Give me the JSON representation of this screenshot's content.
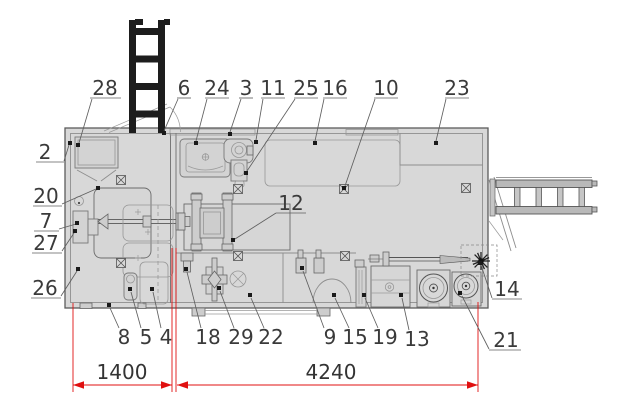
{
  "meta": {
    "drawing_type": "trailer-floor-plan",
    "description": "Top view layout plan of a mobile workshop trailer with numbered callouts and overall dimensions"
  },
  "colors": {
    "dimension": "#e01010",
    "interior": "#d8d8d8",
    "ladder": "#1d1d1d",
    "label": "#3a3a3a"
  },
  "dimensions": [
    {
      "label": "1400",
      "y": 385,
      "x1": 73,
      "x2": 172,
      "text_x": 122,
      "text_y": 379
    },
    {
      "label": "4240",
      "y": 385,
      "x1": 177,
      "x2": 478,
      "text_x": 331,
      "text_y": 379
    }
  ],
  "extension_lines": [
    {
      "x": 73,
      "y1": 303,
      "y2": 392
    },
    {
      "x": 172,
      "y1": 248,
      "y2": 392
    },
    {
      "x": 176,
      "y1": 248,
      "y2": 392
    },
    {
      "x": 478,
      "y1": 302,
      "y2": 392
    }
  ],
  "symbols": [
    {
      "type": "crossed-box",
      "x": 121,
      "y": 180
    },
    {
      "type": "crossed-box",
      "x": 121,
      "y": 263
    },
    {
      "type": "crossed-box",
      "x": 238,
      "y": 189
    },
    {
      "type": "crossed-box",
      "x": 344,
      "y": 189
    },
    {
      "type": "crossed-box",
      "x": 466,
      "y": 188
    },
    {
      "type": "crossed-box",
      "x": 238,
      "y": 256
    },
    {
      "type": "crossed-box",
      "x": 345,
      "y": 256
    }
  ],
  "callouts": [
    {
      "num": "2",
      "x": 45,
      "y": 152,
      "underline": {
        "x1": 36,
        "x2": 64,
        "y": 162
      },
      "leader": "64,161 69,145",
      "tx": 70,
      "ty": 143
    },
    {
      "num": "28",
      "x": 105,
      "y": 88,
      "underline": {
        "x1": 90,
        "x2": 121,
        "y": 98
      },
      "leader": "92,99 79,143",
      "tx": 78,
      "ty": 145
    },
    {
      "num": "6",
      "x": 184,
      "y": 88,
      "underline": {
        "x1": 177,
        "x2": 191,
        "y": 98
      },
      "leader": "178,99 164,131",
      "tx": 164,
      "ty": 133
    },
    {
      "num": "24",
      "x": 217,
      "y": 88,
      "underline": {
        "x1": 205,
        "x2": 229,
        "y": 98
      },
      "leader": "207,99 196,141",
      "tx": 196,
      "ty": 143
    },
    {
      "num": "3",
      "x": 246,
      "y": 88,
      "underline": {
        "x1": 239,
        "x2": 253,
        "y": 98
      },
      "leader": "241,99 230,132",
      "tx": 230,
      "ty": 134
    },
    {
      "num": "11",
      "x": 273,
      "y": 88,
      "underline": {
        "x1": 261,
        "x2": 285,
        "y": 98
      },
      "leader": "263,99 256,140",
      "tx": 256,
      "ty": 142
    },
    {
      "num": "25",
      "x": 306,
      "y": 88,
      "underline": {
        "x1": 294,
        "x2": 318,
        "y": 98
      },
      "leader": "295,99 247,171",
      "tx": 246,
      "ty": 173
    },
    {
      "num": "16",
      "x": 335,
      "y": 88,
      "underline": {
        "x1": 323,
        "x2": 347,
        "y": 98
      },
      "leader": "324,99 315,141",
      "tx": 315,
      "ty": 143
    },
    {
      "num": "10",
      "x": 386,
      "y": 88,
      "underline": {
        "x1": 374,
        "x2": 398,
        "y": 98
      },
      "leader": "375,99 345,186",
      "tx": 344,
      "ty": 188
    },
    {
      "num": "23",
      "x": 457,
      "y": 88,
      "underline": {
        "x1": 445,
        "x2": 469,
        "y": 98
      },
      "leader": "446,99 436,141",
      "tx": 436,
      "ty": 143
    },
    {
      "num": "20",
      "x": 46,
      "y": 196,
      "underline": {
        "x1": 33,
        "x2": 62,
        "y": 206
      },
      "leader": "62,204 96,189",
      "tx": 98,
      "ty": 188
    },
    {
      "num": "7",
      "x": 46,
      "y": 221,
      "underline": {
        "x1": 34,
        "x2": 59,
        "y": 231
      },
      "leader": "59,229 76,224",
      "tx": 77,
      "ty": 223
    },
    {
      "num": "27",
      "x": 46,
      "y": 243,
      "underline": {
        "x1": 32,
        "x2": 62,
        "y": 253
      },
      "leader": "62,251 74,233",
      "tx": 75,
      "ty": 231
    },
    {
      "num": "26",
      "x": 45,
      "y": 288,
      "underline": {
        "x1": 31,
        "x2": 61,
        "y": 298
      },
      "leader": "61,296 77,271",
      "tx": 78,
      "ty": 269
    },
    {
      "num": "12",
      "x": 291,
      "y": 203,
      "underline": {
        "x1": 276,
        "x2": 306,
        "y": 213
      },
      "leader": "276,213 235,239",
      "tx": 233,
      "ty": 240
    },
    {
      "num": "14",
      "x": 507,
      "y": 289,
      "underline": {
        "x1": 492,
        "x2": 522,
        "y": 299
      },
      "leader": "492,298 481,265",
      "tx": 480,
      "ty": 263
    },
    {
      "num": "21",
      "x": 506,
      "y": 340,
      "underline": {
        "x1": 489,
        "x2": 521,
        "y": 350
      },
      "leader": "489,349 462,296",
      "tx": 460,
      "ty": 293
    },
    {
      "num": "8",
      "x": 124,
      "y": 337,
      "leader": "119,328 110,308",
      "tx": 109,
      "ty": 305
    },
    {
      "num": "5",
      "x": 146,
      "y": 337,
      "leader": "141,328 131,292",
      "tx": 130,
      "ty": 289
    },
    {
      "num": "4",
      "x": 166,
      "y": 337,
      "leader": "161,328 153,292",
      "tx": 152,
      "ty": 289
    },
    {
      "num": "18",
      "x": 208,
      "y": 337,
      "leader": "201,328 187,272",
      "tx": 186,
      "ty": 269
    },
    {
      "num": "29",
      "x": 241,
      "y": 337,
      "leader": "234,328 220,291",
      "tx": 219,
      "ty": 288
    },
    {
      "num": "22",
      "x": 271,
      "y": 337,
      "leader": "264,328 251,298",
      "tx": 250,
      "ty": 295
    },
    {
      "num": "9",
      "x": 330,
      "y": 337,
      "leader": "324,328 303,271",
      "tx": 302,
      "ty": 268
    },
    {
      "num": "15",
      "x": 355,
      "y": 337,
      "leader": "349,328 335,298",
      "tx": 334,
      "ty": 295
    },
    {
      "num": "19",
      "x": 385,
      "y": 337,
      "leader": "378,328 365,298",
      "tx": 364,
      "ty": 295
    },
    {
      "num": "13",
      "x": 417,
      "y": 339,
      "leader": "409,330 402,298",
      "tx": 401,
      "ty": 295
    }
  ]
}
